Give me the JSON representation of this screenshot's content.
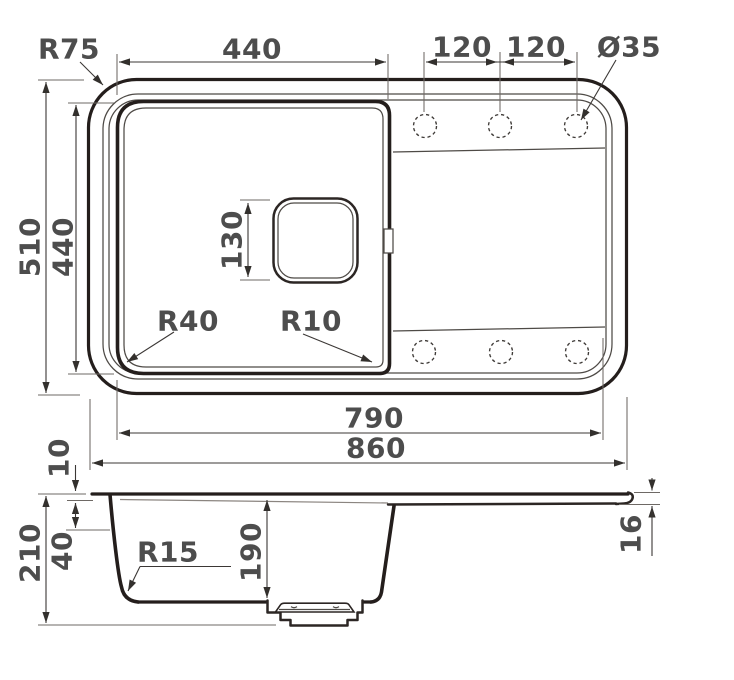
{
  "title": "Kitchen sink dimensional drawing",
  "palette": {
    "background": "#ffffff",
    "line_heavy": "#241e1c",
    "line_light": "#8b8580",
    "dimension_line": "#3b3735",
    "label_text": "#4d4d4d"
  },
  "top_view": {
    "tap_holes_count": 6,
    "labels": {
      "corner_radius": "R75",
      "bowl_width": "440",
      "hole_pitch_1": "120",
      "hole_pitch_2": "120",
      "hole_diameter": "Ø35",
      "overall_depth": "510",
      "bowl_depth": "440",
      "drain_size": "130",
      "bowl_corner_radius": "R40",
      "bowl_corner_radius_right": "R10",
      "inner_length": "790",
      "overall_length": "860"
    }
  },
  "side_view": {
    "labels": {
      "rim_thickness": "10",
      "overall_height": "210",
      "rim_depth": "40",
      "bottom_radius": "R15",
      "bowl_depth": "190",
      "edge_thickness": "16"
    }
  }
}
